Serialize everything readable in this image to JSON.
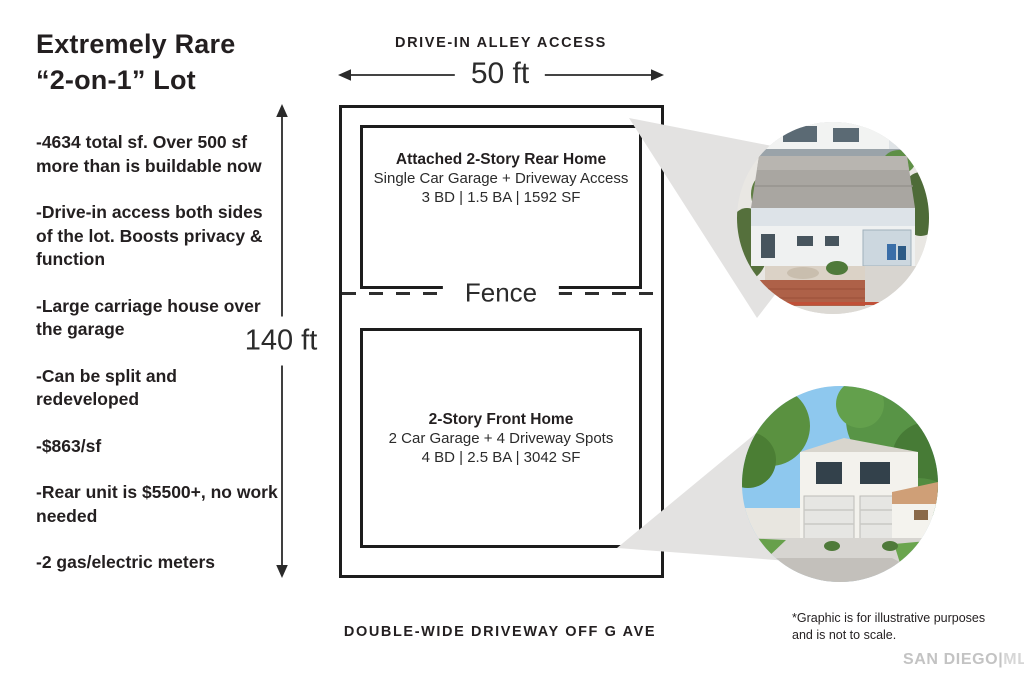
{
  "header": {
    "title_line1": "Extremely Rare",
    "title_line2": "“2-on-1” Lot"
  },
  "bullets": [
    "-4634 total sf. Over 500 sf more than is buildable now",
    "-Drive-in access both sides of the lot. Boosts privacy & function",
    "-Large carriage house over the garage",
    "-Can be split and redeveloped",
    "-$863/sf",
    "-Rear unit is $5500+, no work needed",
    "-2 gas/electric meters"
  ],
  "diagram": {
    "alley_label": "DRIVE-IN ALLEY ACCESS",
    "width_label": "50 ft",
    "height_label": "140 ft",
    "fence_label": "Fence",
    "driveway_label": "DOUBLE-WIDE DRIVEWAY OFF G AVE",
    "rear_home": {
      "title": "Attached 2-Story Rear Home",
      "line2": "Single Car Garage + Driveway Access",
      "line3": "3 BD | 1.5 BA | 1592 SF"
    },
    "front_home": {
      "title": "2-Story Front Home",
      "line2": "2 Car Garage + 4 Driveway Spots",
      "line3": "4 BD | 2.5 BA | 3042 SF"
    }
  },
  "footer": {
    "disclaimer_line1": "*Graphic is for illustrative purposes",
    "disclaimer_line2": "and is not to scale.",
    "watermark_left": "SAN DIEGO",
    "watermark_divider": "|",
    "watermark_right": "MLS"
  },
  "colors": {
    "text": "#231f20",
    "line": "#2a2a2a",
    "wedge": "#e3e2e1",
    "watermark": "#c3c3c3"
  }
}
